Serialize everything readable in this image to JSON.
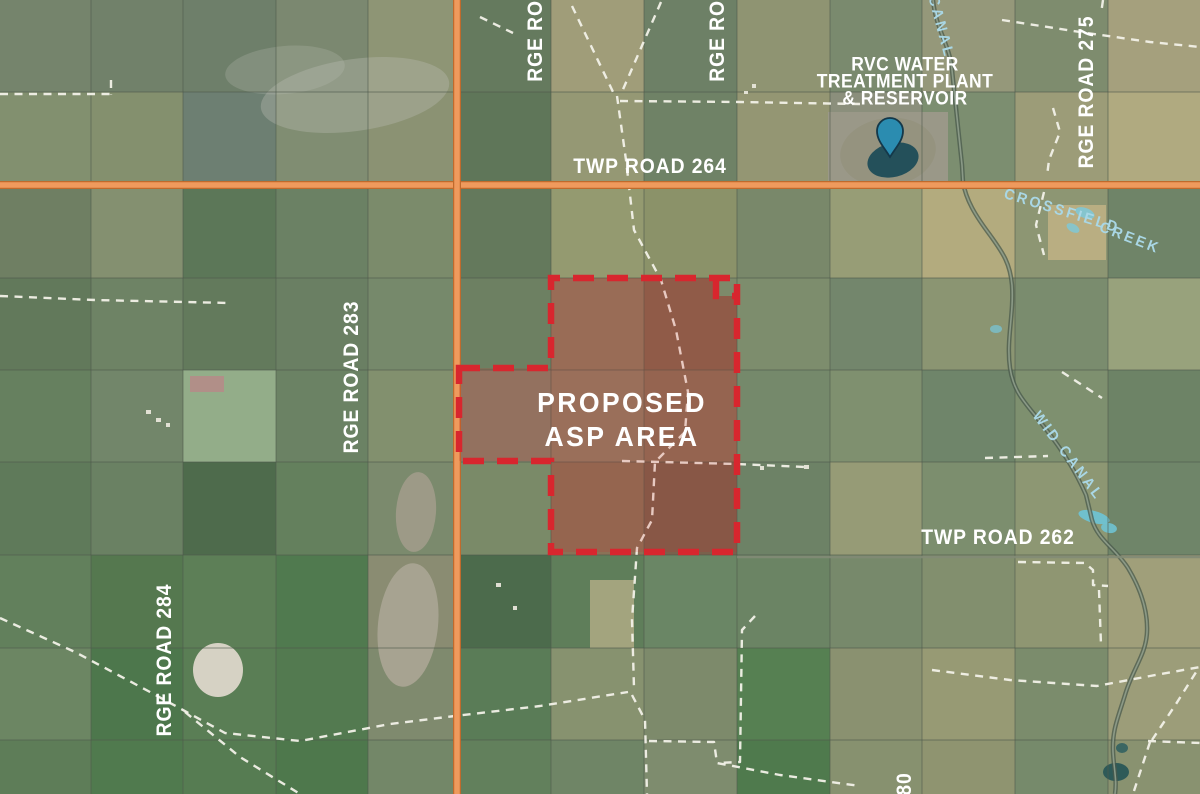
{
  "labels": {
    "twp264": "TWP ROAD 264",
    "twp262": "TWP ROAD 262",
    "rge283": "RGE ROAD 283",
    "rge284": "RGE ROAD 284",
    "rge275": "RGE ROAD 275",
    "rge_top_left": "RGE ROAD",
    "rge_top_right": "RGE ROAD",
    "rge_bottom_fragment": "80",
    "asp_line1": "PROPOSED",
    "asp_line2": "ASP AREA",
    "rvc_line1": "RVC WATER",
    "rvc_line2": "TREATMENT PLANT",
    "rvc_line3": "& RESERVOIR",
    "canal": "CANAL",
    "wid_canal": "WID CANAL",
    "creek_word1": "CROSSFIELD",
    "creek_word2": "CREEK"
  },
  "colors": {
    "asp_outline": "#d8262e",
    "asp_fill": "rgba(208,42,42,0.17)",
    "highway_fill": "#ef9a5d",
    "highway_edge": "#c06a2c",
    "water_label": "#a9d7e5",
    "pin_fill": "#2b8cb0",
    "pin_stroke": "#14384a",
    "dashed_road": "#f2f1e8",
    "grid_line": "#4f5a4d"
  },
  "map": {
    "width": 1200,
    "height": 794,
    "cols_x": [
      0,
      91,
      183,
      276,
      368,
      456,
      551,
      644,
      737,
      830,
      922,
      1015,
      1108,
      1200
    ],
    "rows_y": [
      0,
      92,
      185,
      278,
      370,
      462,
      555,
      648,
      740,
      794
    ],
    "parcel_colors": [
      [
        "#75846c",
        "#71816a",
        "#6e7f6a",
        "#7b8870",
        "#8e9575",
        "#657a5e",
        "#a09d79",
        "#6d8066",
        "#8f9472",
        "#7a8a6e",
        "#95987a",
        "#7e8c6e",
        "#a5a07d"
      ],
      [
        "#82906f",
        "#84906e",
        "#6d7f72",
        "#808d72",
        "#8b9273",
        "#5f7659",
        "#959874",
        "#6f8266",
        "#949673",
        "#8b8f7c",
        "#7c8e70",
        "#9c9c78",
        "#b0aa80"
      ],
      [
        "#6f7f63",
        "#849070",
        "#5c7758",
        "#6b8164",
        "#7b8b6b",
        "#64795c",
        "#949a70",
        "#8b9269",
        "#79886a",
        "#979d76",
        "#b3ab7e",
        "#8d9673",
        "#6f8468"
      ],
      [
        "#62795b",
        "#6e8365",
        "#637a5c",
        "#6a7f63",
        "#76896b",
        "#6d8062",
        "#8f7a5f",
        "#84664f",
        "#7d8d6d",
        "#73866c",
        "#8b9572",
        "#7a8c6e",
        "#98a27c"
      ],
      [
        "#66805f",
        "#72866a",
        "#93ad89",
        "#6b8264",
        "#82906e",
        "#87806a",
        "#907d64",
        "#8a7058",
        "#75896b",
        "#7f906f",
        "#6f856a",
        "#7e906f",
        "#6d8366"
      ],
      [
        "#5f7a5a",
        "#6a8163",
        "#4e6b4c",
        "#64805d",
        "#7b8a6d",
        "#7a8a68",
        "#8a7257",
        "#7a614c",
        "#6d8266",
        "#969b76",
        "#7c8e6e",
        "#8d9773",
        "#6f8569"
      ],
      [
        "#62805c",
        "#55784f",
        "#5d7f57",
        "#507a4f",
        "#8a8c72",
        "#4c6b4c",
        "#5f7e5a",
        "#6a8665",
        "#6b8464",
        "#77896b",
        "#828f6e",
        "#8f9672",
        "#a09f7a"
      ],
      [
        "#6c8663",
        "#4d774c",
        "#5a7e55",
        "#537a50",
        "#7f8a6e",
        "#5a7c57",
        "#87926f",
        "#7d8a6b",
        "#568052",
        "#8a9170",
        "#979a74",
        "#7b8c6c",
        "#9c9d79"
      ],
      [
        "#5e7d58",
        "#507a4e",
        "#567c52",
        "#4e784c",
        "#738768",
        "#62805c",
        "#6f8566",
        "#7e8c6e",
        "#4f7a4d",
        "#87916f",
        "#8f9470",
        "#768a6b",
        "#899270"
      ]
    ],
    "blobs": [
      {
        "cx": 355,
        "cy": 95,
        "rx": 95,
        "ry": 36,
        "fill": "#b7bab0",
        "op": 0.38,
        "rot": -8
      },
      {
        "cx": 285,
        "cy": 70,
        "rx": 60,
        "ry": 24,
        "fill": "#b7bab0",
        "op": 0.28,
        "rot": -5
      },
      {
        "cx": 408,
        "cy": 625,
        "rx": 30,
        "ry": 62,
        "fill": "#a7a391",
        "op": 1,
        "rot": 6
      },
      {
        "cx": 416,
        "cy": 512,
        "rx": 20,
        "ry": 40,
        "fill": "#9d9a87",
        "op": 1,
        "rot": 4
      },
      {
        "cx": 218,
        "cy": 670,
        "rx": 25,
        "ry": 27,
        "fill": "#d6d2c4",
        "op": 1,
        "rot": 0
      },
      {
        "cx": 888,
        "cy": 152,
        "rx": 48,
        "ry": 34,
        "fill": "#95937f",
        "op": 1,
        "rot": -8
      },
      {
        "cx": 893,
        "cy": 160,
        "rx": 26,
        "ry": 17,
        "fill": "#24505a",
        "op": 1,
        "rot": -14
      },
      {
        "cx": 1085,
        "cy": 213,
        "rx": 10,
        "ry": 5,
        "fill": "#7fc8d6",
        "op": 0.9,
        "rot": 20
      },
      {
        "cx": 1073,
        "cy": 228,
        "rx": 7,
        "ry": 4,
        "fill": "#7fc8d6",
        "op": 0.85,
        "rot": 30
      },
      {
        "cx": 996,
        "cy": 329,
        "rx": 6,
        "ry": 4,
        "fill": "#79c0ce",
        "op": 0.8,
        "rot": 0
      },
      {
        "cx": 1094,
        "cy": 517,
        "rx": 16,
        "ry": 6,
        "fill": "#6fc2d2",
        "op": 0.95,
        "rot": 15
      },
      {
        "cx": 1109,
        "cy": 528,
        "rx": 8,
        "ry": 5,
        "fill": "#6fc2d2",
        "op": 0.9,
        "rot": 10
      },
      {
        "cx": 1116,
        "cy": 772,
        "rx": 13,
        "ry": 9,
        "fill": "#2e5a58",
        "op": 1,
        "rot": 0
      },
      {
        "cx": 1122,
        "cy": 748,
        "rx": 6,
        "ry": 5,
        "fill": "#3a6662",
        "op": 1,
        "rot": 0
      }
    ],
    "patches": [
      {
        "x": 1048,
        "y": 205,
        "w": 58,
        "h": 55,
        "fill": "#b9ae82"
      },
      {
        "x": 590,
        "y": 580,
        "w": 44,
        "h": 68,
        "fill": "#a3a47e"
      },
      {
        "x": 190,
        "y": 376,
        "w": 34,
        "h": 16,
        "fill": "#b18f88"
      },
      {
        "x": 716,
        "y": 278,
        "w": 21,
        "h": 18,
        "fill": "#7d8a6a"
      },
      {
        "x": 828,
        "y": 112,
        "w": 120,
        "h": 74,
        "fill": "#9a9888"
      }
    ],
    "dots": [
      {
        "x": 146,
        "y": 410,
        "w": 5,
        "h": 4
      },
      {
        "x": 156,
        "y": 418,
        "w": 5,
        "h": 4
      },
      {
        "x": 166,
        "y": 423,
        "w": 4,
        "h": 4
      },
      {
        "x": 804,
        "y": 465,
        "w": 5,
        "h": 4
      },
      {
        "x": 760,
        "y": 466,
        "w": 4,
        "h": 4
      },
      {
        "x": 496,
        "y": 583,
        "w": 5,
        "h": 4
      },
      {
        "x": 513,
        "y": 606,
        "w": 4,
        "h": 4
      },
      {
        "x": 752,
        "y": 84,
        "w": 4,
        "h": 4
      },
      {
        "x": 744,
        "y": 91,
        "w": 4,
        "h": 3
      }
    ],
    "dashed_roads": [
      [
        [
          0,
          94
        ],
        [
          110,
          94
        ]
      ],
      [
        [
          111,
          80
        ],
        [
          111,
          95
        ]
      ],
      [
        [
          0,
          296
        ],
        [
          95,
          300
        ],
        [
          230,
          303
        ]
      ],
      [
        [
          572,
          6
        ],
        [
          614,
          94
        ]
      ],
      [
        [
          661,
          2
        ],
        [
          621,
          94
        ]
      ],
      [
        [
          617,
          96
        ],
        [
          626,
          160
        ],
        [
          634,
          230
        ],
        [
          661,
          280
        ],
        [
          676,
          330
        ],
        [
          688,
          392
        ],
        [
          685,
          432
        ],
        [
          655,
          462
        ],
        [
          652,
          520
        ],
        [
          637,
          548
        ],
        [
          632,
          620
        ],
        [
          634,
          688
        ]
      ],
      [
        [
          620,
          101
        ],
        [
          740,
          102
        ],
        [
          860,
          104
        ]
      ],
      [
        [
          480,
          17
        ],
        [
          513,
          33
        ]
      ],
      [
        [
          622,
          461
        ],
        [
          737,
          464
        ],
        [
          806,
          467
        ]
      ],
      [
        [
          1002,
          20
        ],
        [
          1080,
          32
        ],
        [
          1150,
          42
        ],
        [
          1200,
          47
        ]
      ],
      [
        [
          1103,
          0
        ],
        [
          1101,
          14
        ]
      ],
      [
        [
          1053,
          108
        ],
        [
          1060,
          132
        ],
        [
          1049,
          160
        ],
        [
          1047,
          176
        ]
      ],
      [
        [
          1044,
          192
        ],
        [
          1036,
          225
        ],
        [
          1044,
          255
        ]
      ],
      [
        [
          985,
          458
        ],
        [
          1048,
          456
        ]
      ],
      [
        [
          1062,
          372
        ],
        [
          1102,
          398
        ]
      ],
      [
        [
          1018,
          562
        ],
        [
          1085,
          563
        ],
        [
          1093,
          570
        ],
        [
          1093,
          585
        ],
        [
          1108,
          586
        ]
      ],
      [
        [
          1099,
          590
        ],
        [
          1101,
          645
        ]
      ],
      [
        [
          932,
          670
        ],
        [
          1010,
          680
        ],
        [
          1097,
          686
        ],
        [
          1150,
          676
        ],
        [
          1200,
          667
        ]
      ],
      [
        [
          1152,
          740
        ],
        [
          1176,
          704
        ],
        [
          1198,
          669
        ]
      ],
      [
        [
          1148,
          741
        ],
        [
          1200,
          743
        ]
      ],
      [
        [
          1150,
          742
        ],
        [
          1133,
          794
        ]
      ],
      [
        [
          0,
          618
        ],
        [
          75,
          652
        ],
        [
          150,
          692
        ],
        [
          225,
          733
        ],
        [
          300,
          741
        ],
        [
          390,
          724
        ],
        [
          455,
          716
        ],
        [
          540,
          706
        ],
        [
          628,
          692
        ]
      ],
      [
        [
          185,
          712
        ],
        [
          240,
          757
        ],
        [
          300,
          794
        ]
      ],
      [
        [
          632,
          695
        ],
        [
          645,
          720
        ],
        [
          647,
          794
        ]
      ],
      [
        [
          649,
          741
        ],
        [
          714,
          742
        ],
        [
          717,
          763
        ],
        [
          780,
          775
        ],
        [
          860,
          786
        ]
      ],
      [
        [
          755,
          616
        ],
        [
          742,
          630
        ],
        [
          740,
          762
        ],
        [
          717,
          763
        ]
      ]
    ],
    "canal_path": "M933,0 C936,30 950,45 952,70 C955,100 959,135 962,165 L963,182 C966,200 975,215 990,235 C1002,252 1010,262 1012,285 C1014,315 1006,340 1010,368 C1014,395 1028,405 1045,428 C1062,450 1075,470 1086,495 L1092,520 C1098,540 1115,548 1128,568 C1140,588 1148,610 1147,632 C1146,655 1133,668 1125,695 C1118,718 1112,730 1113,752 C1114,770 1117,780 1115,794",
    "highway_h_y": 185,
    "highway_v_x": 457,
    "grey_road": {
      "x1": 737,
      "y1": 557,
      "x2": 1200,
      "y2": 557
    },
    "asp_fill_path": "M551,278 L716,278 L716,296 L737,296 L737,552 L551,552 L551,461 L459,461 L459,368 L551,368 Z",
    "asp_outline_path": "M459,368 L551,368 L551,278 L737,278 L737,552 L551,552 L551,461 L459,461 Z",
    "asp_notch_path": "M716,278 L716,296 L737,296",
    "pin": {
      "x": 890,
      "y": 157
    }
  }
}
